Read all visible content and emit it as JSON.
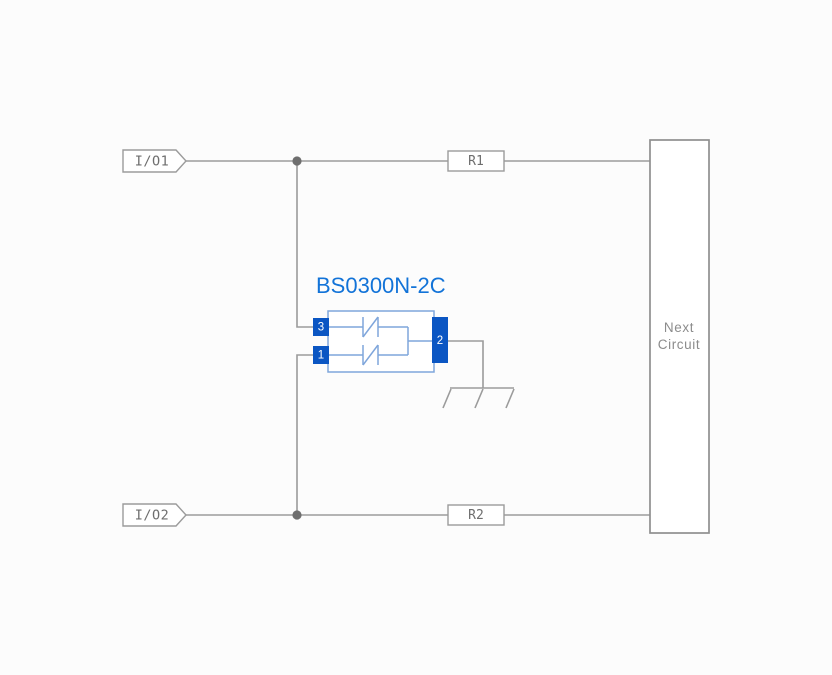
{
  "schematic": {
    "title": "BS0300N-2C",
    "io": {
      "top": "I/O1",
      "bottom": "I/O2"
    },
    "resistors": {
      "top": "R1",
      "bottom": "R2"
    },
    "next_circuit": {
      "line1": "Next",
      "line2": "Circuit"
    },
    "pins": {
      "top_left": "3",
      "bottom_left": "1",
      "common": "2"
    }
  },
  "colors": {
    "background": "#FCFCFC",
    "wire": "#9B9B9B",
    "junction_dot": "#6E6E6E",
    "label_text": "#6E6E6E",
    "box_outline": "#9B9B9B",
    "next_circuit_outline": "#8F8F8F",
    "next_circuit_text": "#8C8C8C",
    "component_outline": "#7FA6DB",
    "pin_fill": "#0B56C3",
    "pin_number_text": "#FFFFFF",
    "title_text": "#1273D8"
  }
}
